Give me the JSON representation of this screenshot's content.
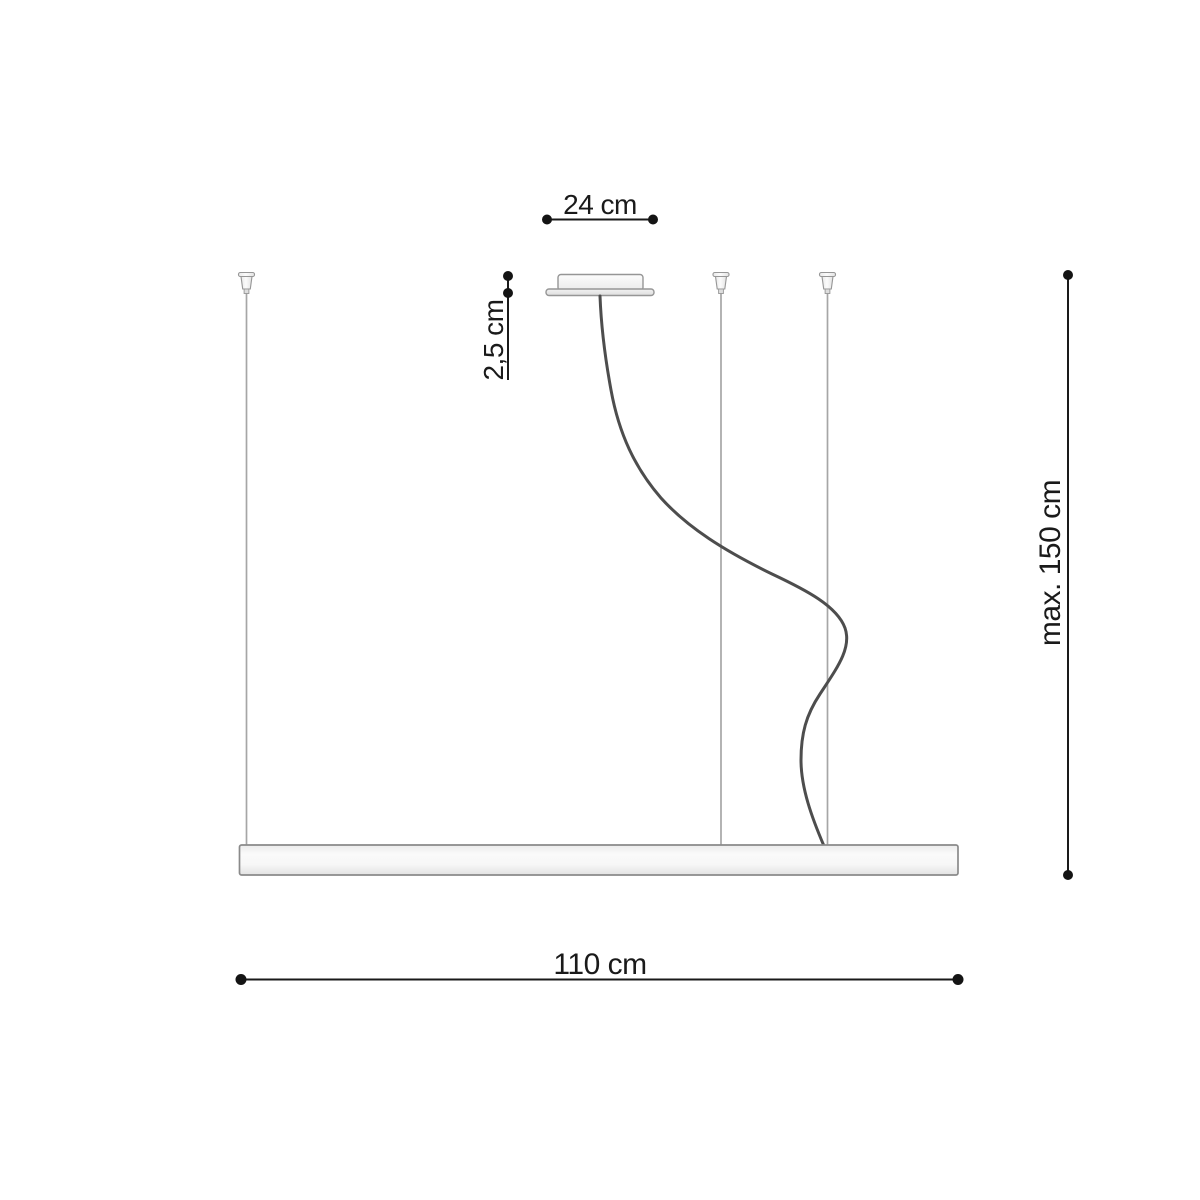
{
  "diagram": {
    "labels": {
      "canopy_width": "24 cm",
      "canopy_height": "2,5 cm",
      "fixture_length": "110 cm",
      "max_height": "max. 150 cm"
    },
    "colors": {
      "dimension_ink": "#1a1a1a",
      "outline_gray": "#969696",
      "cable_dark": "#4d4d4d",
      "wire_gray": "#a6a6a6",
      "fixture_fill_light": "#fbfbfb",
      "fixture_fill_shade": "#e5e5e5",
      "background": "#ffffff"
    }
  }
}
